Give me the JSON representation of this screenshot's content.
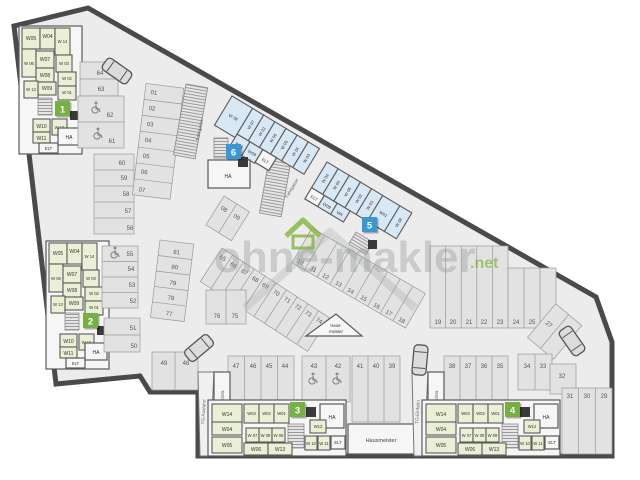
{
  "colors": {
    "green_marker": "#76b043",
    "blue_marker": "#3b97d3",
    "room_green": "#eaf0d6",
    "room_blue": "#d9e8f5",
    "wall": "#4a4a4a",
    "accent_green": "#7db232"
  },
  "watermark": {
    "brand": "ohne-makler",
    "tld": ".net"
  },
  "markers": [
    "1",
    "2",
    "3",
    "4",
    "5",
    "6"
  ],
  "labels": {
    "fahrgasse": "Fahrgasse",
    "hausmeister": "Hausmeister",
    "hausmeister_line1": "Haus-",
    "hausmeister_line2": "meister",
    "tg_ausfahrt": "TG-Ausfahrt",
    "tg_einfahrt": "TG-Einfahrt",
    "kiwa": "KiWa"
  },
  "k12": {
    "rooms": [
      "W05",
      "W04",
      "W 14",
      "W 06",
      "W07",
      "W 03",
      "W08",
      "W 02",
      "W09",
      "W 13",
      "W 01",
      "W10",
      "W 12",
      "W11",
      "ELT",
      "HA"
    ]
  },
  "k34": {
    "rooms": [
      "W14",
      "W03",
      "W02",
      "W01",
      "HA",
      "W04",
      "W 07",
      "W 08",
      "W 09",
      "W12",
      "W05",
      "W06",
      "W13",
      "W 10",
      "W 11",
      "ELT"
    ]
  },
  "k6": {
    "rooms": [
      "W 08",
      "W 07",
      "W 02",
      "W 06",
      "W 05",
      "W 04",
      "W 03",
      "W01",
      "W09",
      "ELT",
      "HA"
    ]
  },
  "k5": {
    "rooms": [
      "W 04",
      "W 05",
      "W 06",
      "W 02",
      "W 03",
      "W01",
      "W 08",
      "ELT",
      "W09",
      "WA"
    ]
  },
  "p": {
    "a": [
      "01",
      "02",
      "03",
      "04",
      "05",
      "06",
      "07"
    ],
    "b": [
      "08",
      "09"
    ],
    "c": [
      "10",
      "11",
      "12",
      "13",
      "14",
      "15",
      "16",
      "17",
      "18"
    ],
    "d": [
      "19",
      "20",
      "21",
      "22",
      "23",
      "24",
      "25",
      "26"
    ],
    "e": [
      "27",
      "28"
    ],
    "f": [
      "29",
      "30",
      "31"
    ],
    "g": [
      "32",
      "33",
      "34"
    ],
    "h": [
      "35",
      "36",
      "37",
      "38"
    ],
    "i": [
      "39",
      "40",
      "41"
    ],
    "j": [
      "42",
      "43"
    ],
    "k": [
      "44",
      "45",
      "46",
      "47"
    ],
    "l": [
      "48",
      "49"
    ],
    "n": [
      "50",
      "51",
      "52",
      "53",
      "54",
      "55"
    ],
    "o": [
      "56",
      "57",
      "58",
      "59",
      "60",
      "61",
      "62",
      "63",
      "64"
    ],
    "q": [
      "65",
      "66",
      "67",
      "68",
      "69",
      "70",
      "71",
      "72",
      "73",
      "74"
    ],
    "r": [
      "75",
      "76"
    ],
    "s": [
      "77",
      "78",
      "79",
      "80",
      "81"
    ]
  }
}
